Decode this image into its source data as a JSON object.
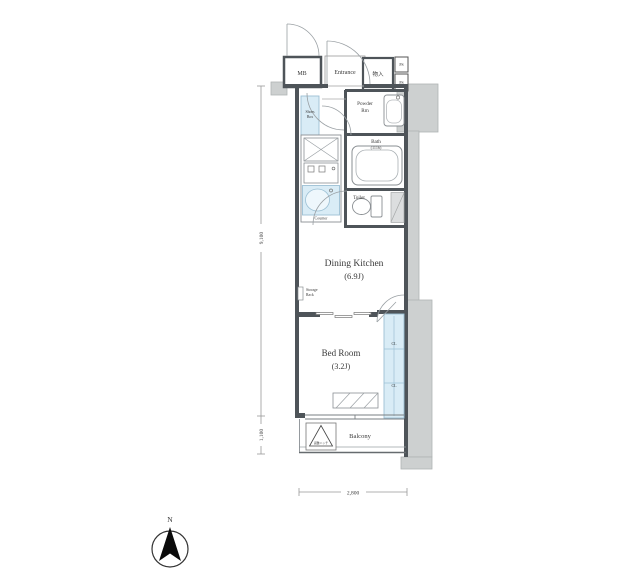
{
  "rooms": {
    "mb": "MB",
    "entrance": "Entrance",
    "storage": "物入",
    "ps_upper": "PS",
    "ps_lower": "PS",
    "powder_line1": "Powder",
    "powder_line2": "Rm",
    "bath": "Bath",
    "bath_size": "(1116)",
    "toilet": "Toilet",
    "shoes_line1": "Shoes",
    "shoes_line2": "Box",
    "counter": "Counter",
    "dining_kitchen": "Dining Kitchen",
    "dining_kitchen_size": "(6.9J)",
    "rack_line1": "Storage",
    "rack_line2": "Rack",
    "bed_room": "Bed Room",
    "bed_room_size": "(3.2J)",
    "closet_upper": "CL",
    "closet_lower": "CL",
    "balcony": "Balcony",
    "hatch": "避難ハッチ"
  },
  "dimensions": {
    "height_main": "9,100",
    "height_balcony": "1,100",
    "width_bottom": "2,800"
  },
  "compass": {
    "north": "N"
  },
  "colors": {
    "wall": "#4e5459",
    "exterior_fill": "#cdd0d0",
    "fixture_blue": "#d9ecf6",
    "line_gray": "#8a8f93",
    "text": "#3a3a3a"
  }
}
